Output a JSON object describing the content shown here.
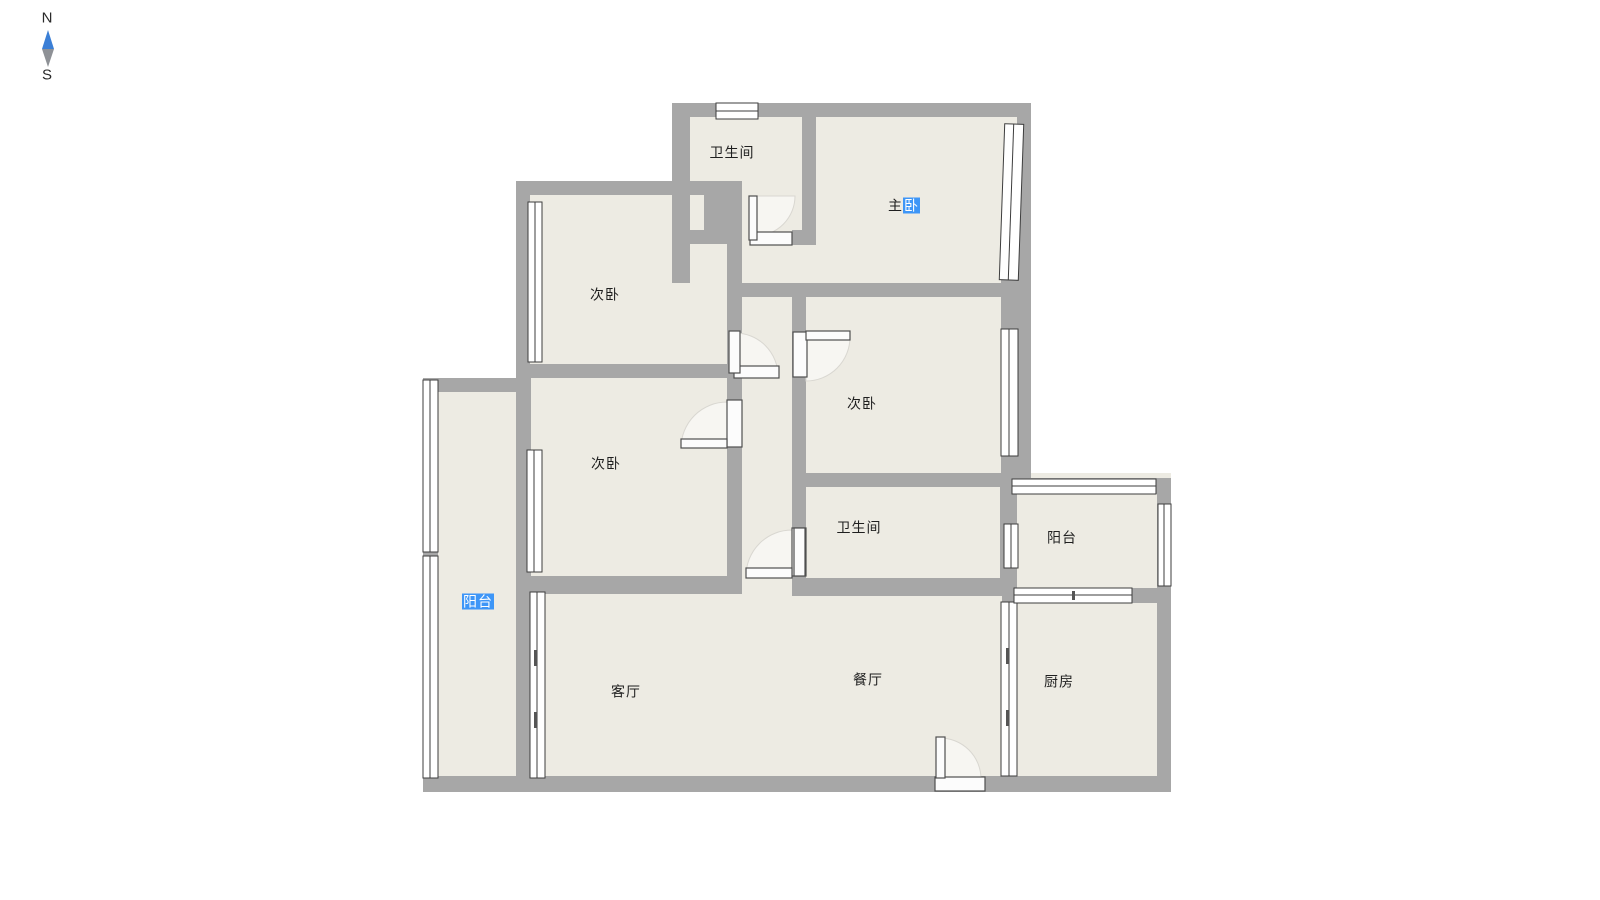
{
  "compass": {
    "north": "N",
    "south": "S"
  },
  "palette": {
    "wall": "#a7a7a7",
    "floor": "#edebe3",
    "window_stroke": "#3d3d3d",
    "door_stroke": "#4f4f4f",
    "door_swing_fill": "#f7f6f2",
    "selection": "#3e96f7",
    "selection_text": "#ffffff",
    "label_text": "#1f1f1f",
    "compass_north": "#3b7fd6",
    "compass_south": "#8e9196"
  },
  "rooms": {
    "bathroom_top": {
      "label": "卫生间"
    },
    "master_bedroom": {
      "label": "主卧",
      "label_normal": "主",
      "label_selected": "卧"
    },
    "bedroom_top_left": {
      "label": "次卧"
    },
    "bedroom_mid_left": {
      "label": "次卧"
    },
    "bedroom_center": {
      "label": "次卧"
    },
    "bathroom_mid": {
      "label": "卫生间"
    },
    "balcony_left": {
      "label": "阳台"
    },
    "balcony_right": {
      "label": "阳台"
    },
    "living_room": {
      "label": "客厅"
    },
    "dining_room": {
      "label": "餐厅"
    },
    "kitchen": {
      "label": "厨房"
    }
  }
}
